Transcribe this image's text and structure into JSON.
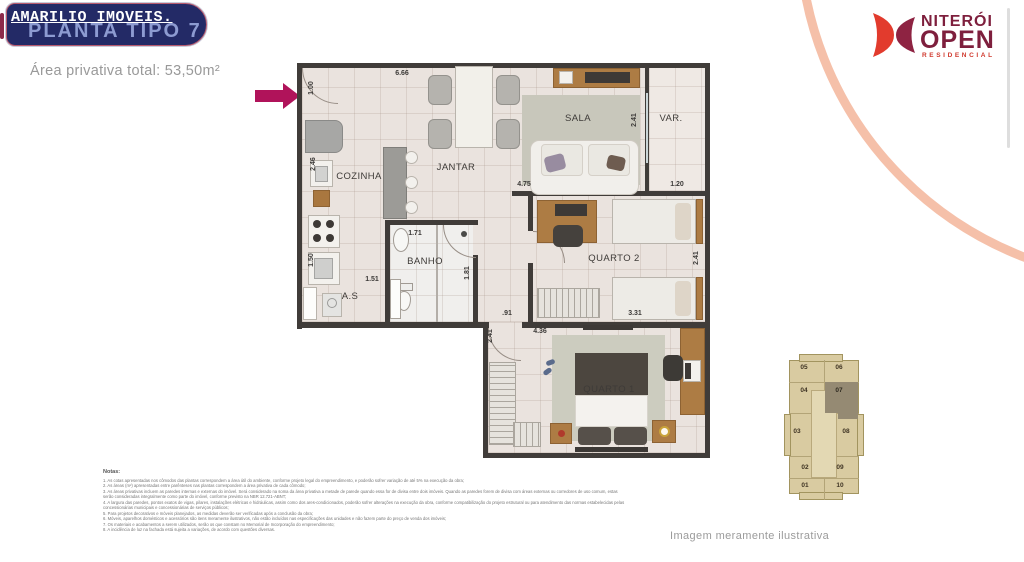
{
  "header": {
    "brand": "AMARILIO IMOVEIS.",
    "plan_title": "PLANTA TIPO 7",
    "area_total": "Área privativa total: 53,50m²"
  },
  "logo": {
    "name": "NITERÓI",
    "type": "OPEN",
    "sub": "RESIDENCIAL"
  },
  "floorplan": {
    "rooms": {
      "cozinha": "COZINHA",
      "jantar": "JANTAR",
      "sala": "SALA",
      "varanda": "VAR.",
      "banho": "BANHO",
      "area_servico": "A.S",
      "quarto2": "QUARTO 2",
      "quarto1": "QUARTO 1"
    },
    "dims": {
      "top_width": "6.66",
      "entry_width": "1.00",
      "kitchen_depth": "2.46",
      "kitchen_lower": "1.50",
      "as_width": "1.51",
      "banho_width": "1.71",
      "banho_depth": "1.81",
      "sala_width": "4.75",
      "sala_depth": "2.41",
      "var_width": "1.20",
      "q2_depth": "2.41",
      "q2_width": "3.31",
      "hall_width": ".91",
      "q1_depth": "2.41",
      "q1_width": "4.36"
    }
  },
  "keyplan": {
    "units": [
      {
        "label": "05"
      },
      {
        "label": "06"
      },
      {
        "label": "04"
      },
      {
        "label": "07"
      },
      {
        "label": "03"
      },
      {
        "label": "08"
      },
      {
        "label": "02"
      },
      {
        "label": "09"
      },
      {
        "label": "01"
      },
      {
        "label": "10"
      }
    ],
    "highlighted": "07"
  },
  "notes": {
    "title": "Notas:",
    "lines": [
      "1. As cotas apresentadas nos cômodos das plantas correspondem a área útil do ambiente, conforme projeto legal do empreendimento, e poderão sofrer variação de até 5% na execução da obra;",
      "2. As áreas (m²) apresentadas entre parênteses nas plantas correspondem a área privativa de cada cômodo;",
      "3. As áreas privativas incluem as paredes internas e externas do imóvel. Será considerado na soma da área privativa a metade de parede quando essa for de divisa entre dois imóveis. Quando as paredes forem de divisa com áreas externas ou corredores de uso comum, estas serão consideradas integralmente como parte do imóvel, conforme previsto na NBR 12.721-ABNT;",
      "4. A largura das paredes, pontos exatos de vigas, pilares, instalações elétricas e hidráulicas, assim como dos ares-condicionados, poderão sofrer alterações na execução da obra, conforme compatibilização do projeto estrutural ou para atendimento das normas estabelecidas pelas concessionárias municipais e concessionárias de serviços públicos;",
      "5. Para projetos decorativos e móveis planejados, as medidas deverão ser verificadas após a conclusão da obra;",
      "6. Móveis, aparelhos domésticos e acessórios são itens meramente ilustrativos, não estão incluídos nas especificações das unidades e não fazem parte do preço de venda dos imóveis;",
      "7. Os materiais e acabamentos a serem utilizados, serão os que constam no Memorial de Incorporação do empreendimento;",
      "8. A incidência de luz na fachada está sujeita a variações, de acordo com questões diversas."
    ]
  },
  "footer": {
    "disclaimer": "Imagem meramente ilustrativa"
  },
  "colors": {
    "accent_navy": "#232a66",
    "accent_magenta": "#b0135a",
    "title_blue": "#8d9bd1",
    "logo_red": "#d0392e",
    "logo_maroon": "#7e1f3d",
    "salmon_arc": "#f5c0a9",
    "wall": "#403c39",
    "floor": "#eae3de",
    "keyplan_beige": "#d9cba1",
    "keyplan_highlight": "#958a73"
  }
}
